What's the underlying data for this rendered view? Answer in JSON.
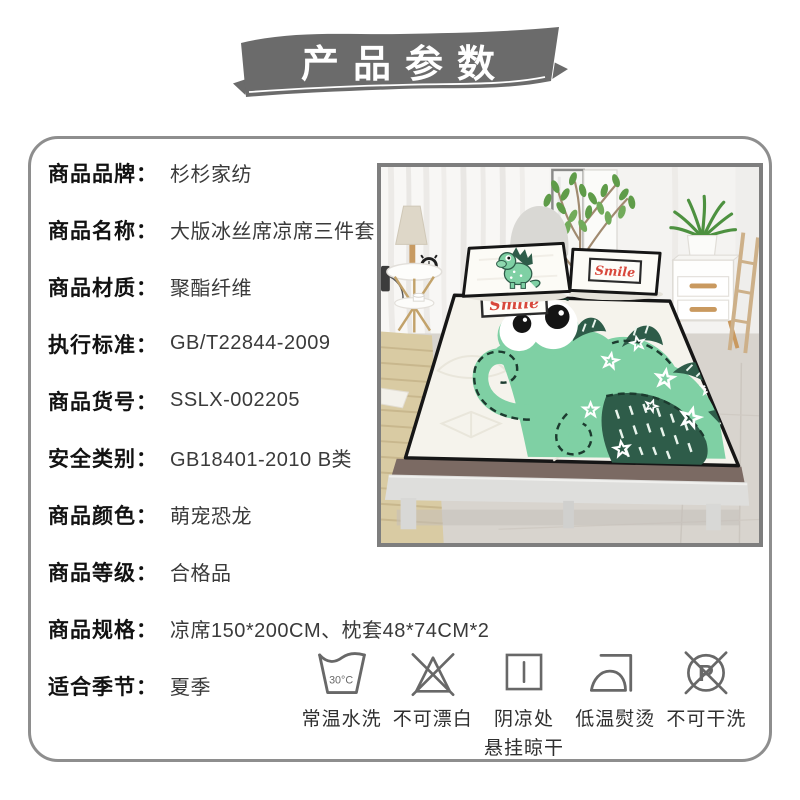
{
  "banner": {
    "title": "产品参数",
    "bg_color": "#6b6b6b",
    "text_color": "#ffffff"
  },
  "specs": {
    "separator": "：",
    "rows": [
      {
        "label": "商品品牌",
        "value": "杉杉家纺"
      },
      {
        "label": "商品名称",
        "value": "大版冰丝席凉席三件套"
      },
      {
        "label": "商品材质",
        "value": "聚酯纤维"
      },
      {
        "label": "执行标准",
        "value": "GB/T22844-2009"
      },
      {
        "label": "商品货号",
        "value": "SSLX-002205"
      },
      {
        "label": "安全类别",
        "value": "GB18401-2010 B类"
      },
      {
        "label": "商品颜色",
        "value": "萌宠恐龙"
      },
      {
        "label": "商品等级",
        "value": "合格品"
      },
      {
        "label": "商品规格",
        "value": "凉席150*200CM、枕套48*74CM*2"
      },
      {
        "label": "适合季节",
        "value": "夏季"
      }
    ]
  },
  "care": {
    "items": [
      {
        "name": "wash-basin-30c",
        "label": "常温水洗",
        "temp": "30°C"
      },
      {
        "name": "no-bleach",
        "label": "不可漂白"
      },
      {
        "name": "shade-hang-dry",
        "label": "阴凉处",
        "label2": "悬挂晾干"
      },
      {
        "name": "low-temp-iron",
        "label": "低温熨烫"
      },
      {
        "name": "no-dry-clean",
        "label": "不可干洗",
        "letter": "P"
      }
    ]
  },
  "photo": {
    "smile_text": "Smile",
    "colors": {
      "dino_green": "#7fd0a4",
      "dino_dark_green": "#2e5c49",
      "smile_red": "#d8483c",
      "mat_white": "#f5f3ec",
      "piping_black": "#161616"
    }
  },
  "frame": {
    "border_color": "#8e8e8e",
    "photo_border_color": "#7e7e7e"
  }
}
